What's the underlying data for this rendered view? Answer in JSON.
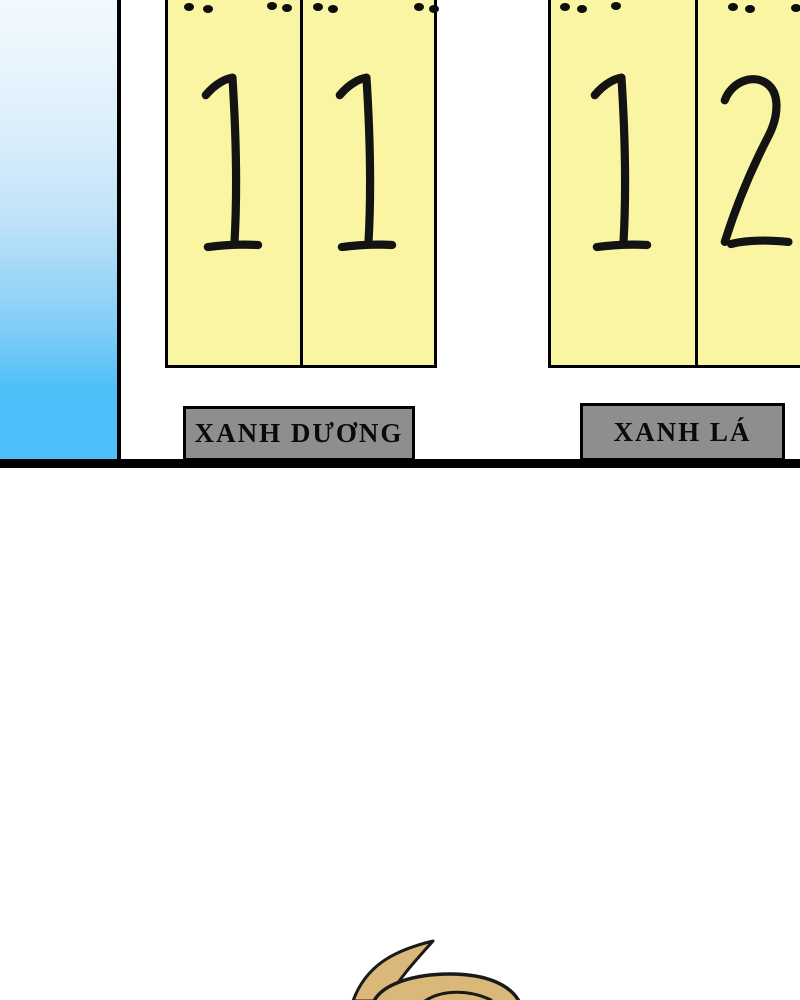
{
  "scene": {
    "type": "comic-scoreboard-panel"
  },
  "scoreboard": {
    "teams": [
      {
        "name": "XANH DƯƠNG",
        "score": "11",
        "digits": [
          "1",
          "1"
        ]
      },
      {
        "name": "XANH LÁ",
        "score": "12",
        "digits": [
          "1",
          "2"
        ]
      }
    ]
  },
  "colors": {
    "card_yellow": "#faf5a3",
    "label_gray": "#8e8e8e",
    "line_black": "#000000",
    "sky_top": "#f3fafe",
    "sky_bottom": "#4dbef7",
    "hair_tan": "#d9b87a",
    "outline": "#1a1a1a"
  }
}
